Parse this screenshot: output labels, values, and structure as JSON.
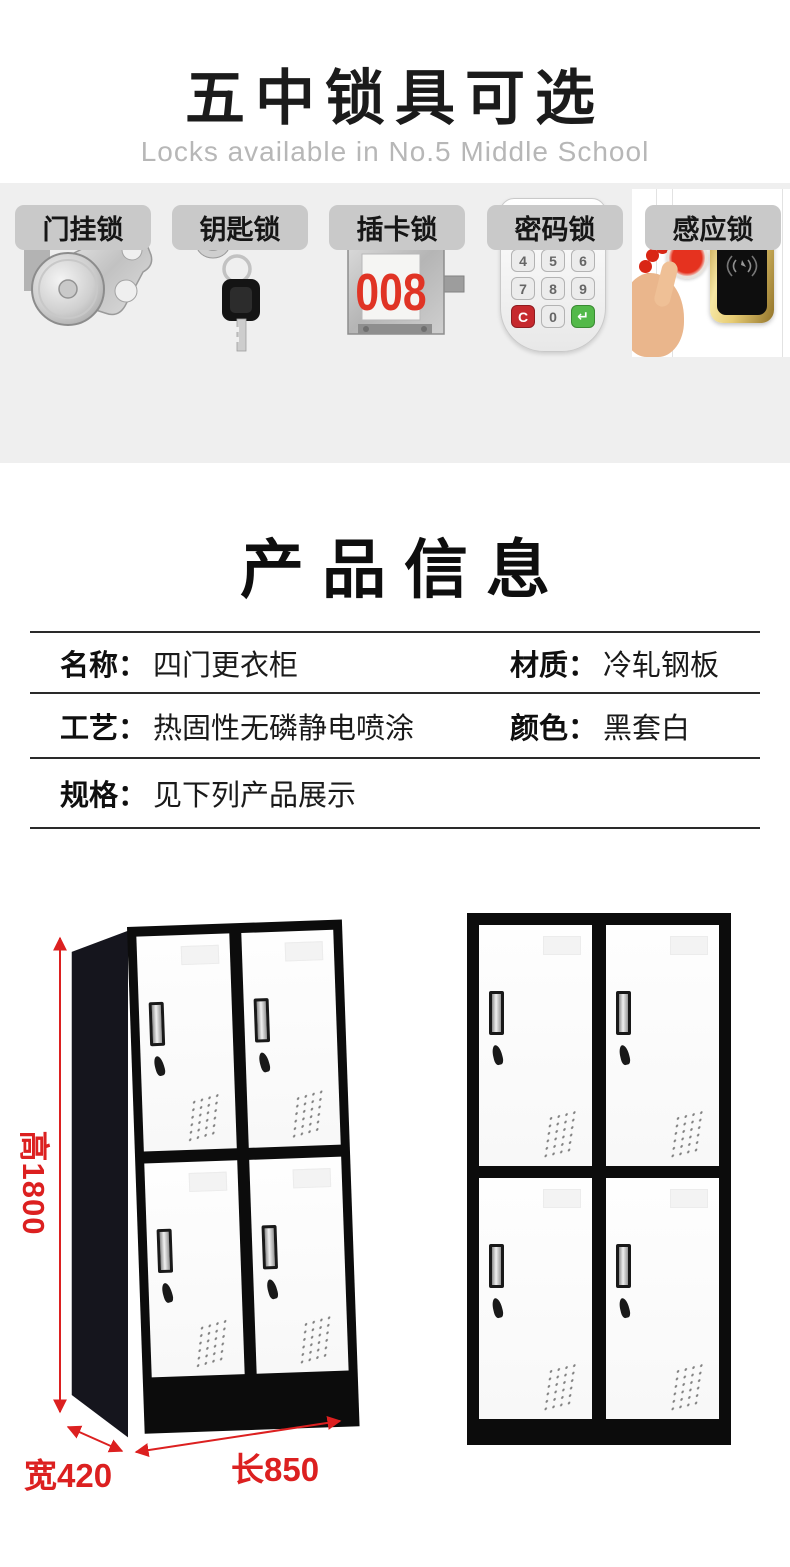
{
  "header": {
    "title": "五中锁具可选",
    "subtitle": "Locks available in No.5 Middle School"
  },
  "locks": {
    "items": [
      {
        "label": "门挂锁",
        "icon": "cam-lock-icon"
      },
      {
        "label": "钥匙锁",
        "icon": "key-lock-icon"
      },
      {
        "label": "插卡锁",
        "icon": "card-lock-icon",
        "display": "008"
      },
      {
        "label": "密码锁",
        "icon": "keypad-lock-icon",
        "keys": [
          "1",
          "2",
          "3",
          "4",
          "5",
          "6",
          "7",
          "8",
          "9",
          "C",
          "0",
          "↵"
        ]
      },
      {
        "label": "感应锁",
        "icon": "sensor-lock-icon"
      }
    ]
  },
  "product_info": {
    "title": "产品信息",
    "rows": [
      {
        "left_label": "名称：",
        "left_value": "四门更衣柜",
        "right_label": "材质：",
        "right_value": "冷轧钢板"
      },
      {
        "left_label": "工艺：",
        "left_value": "热固性无磷静电喷涂",
        "right_label": "颜色：",
        "right_value": "黑套白"
      },
      {
        "left_label": "规格：",
        "left_value": "见下列产品展示"
      }
    ]
  },
  "dimensions": {
    "height": "高1800",
    "width": "宽420",
    "length": "长850"
  },
  "colors": {
    "accent_red": "#dc2020",
    "band_bg": "#efefef",
    "chip_bg": "#c9c9c9",
    "locker_black": "#0c0c0c"
  }
}
